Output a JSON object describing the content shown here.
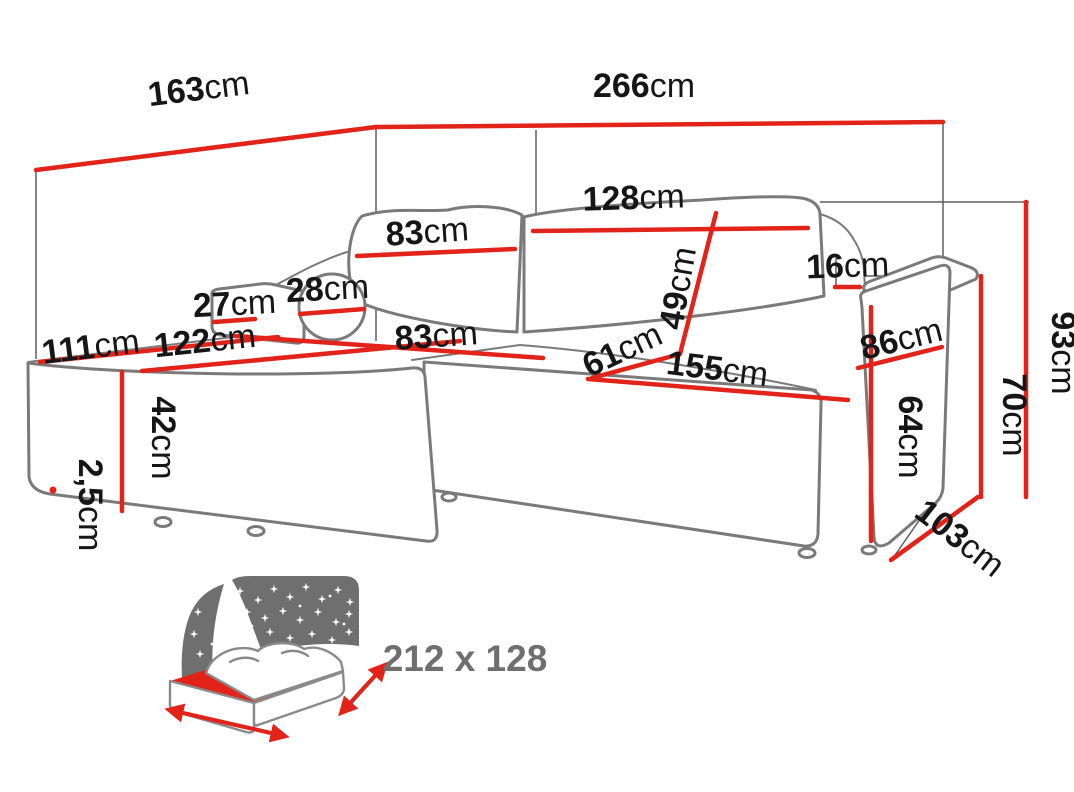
{
  "dims": {
    "d163": {
      "value": "163",
      "unit": "cm"
    },
    "d266": {
      "value": "266",
      "unit": "cm"
    },
    "d128": {
      "value": "128",
      "unit": "cm"
    },
    "d83_back": {
      "value": "83",
      "unit": "cm"
    },
    "d49": {
      "value": "49",
      "unit": "cm"
    },
    "d16": {
      "value": "16",
      "unit": "cm"
    },
    "d28": {
      "value": "28",
      "unit": "cm"
    },
    "d27": {
      "value": "27",
      "unit": "cm"
    },
    "d83_seat": {
      "value": "83",
      "unit": "cm"
    },
    "d122": {
      "value": "122",
      "unit": "cm"
    },
    "d111": {
      "value": "111",
      "unit": "cm"
    },
    "d61": {
      "value": "61",
      "unit": "cm"
    },
    "d155": {
      "value": "155",
      "unit": "cm"
    },
    "d86": {
      "value": "86",
      "unit": "cm"
    },
    "d93": {
      "value": "93",
      "unit": "cm"
    },
    "d70": {
      "value": "70",
      "unit": "cm"
    },
    "d64": {
      "value": "64",
      "unit": "cm"
    },
    "d42": {
      "value": "42",
      "unit": "cm"
    },
    "d2_5": {
      "value": "2,5",
      "unit": "cm"
    },
    "d103": {
      "value": "103",
      "unit": "cm"
    }
  },
  "bed_icon": {
    "size_label": "212 x 128"
  },
  "colors": {
    "dimension_red": "#e2231a",
    "outline_gray": "#7a7a7a",
    "label_black": "#161616",
    "icon_gray": "#6f6f6f"
  }
}
